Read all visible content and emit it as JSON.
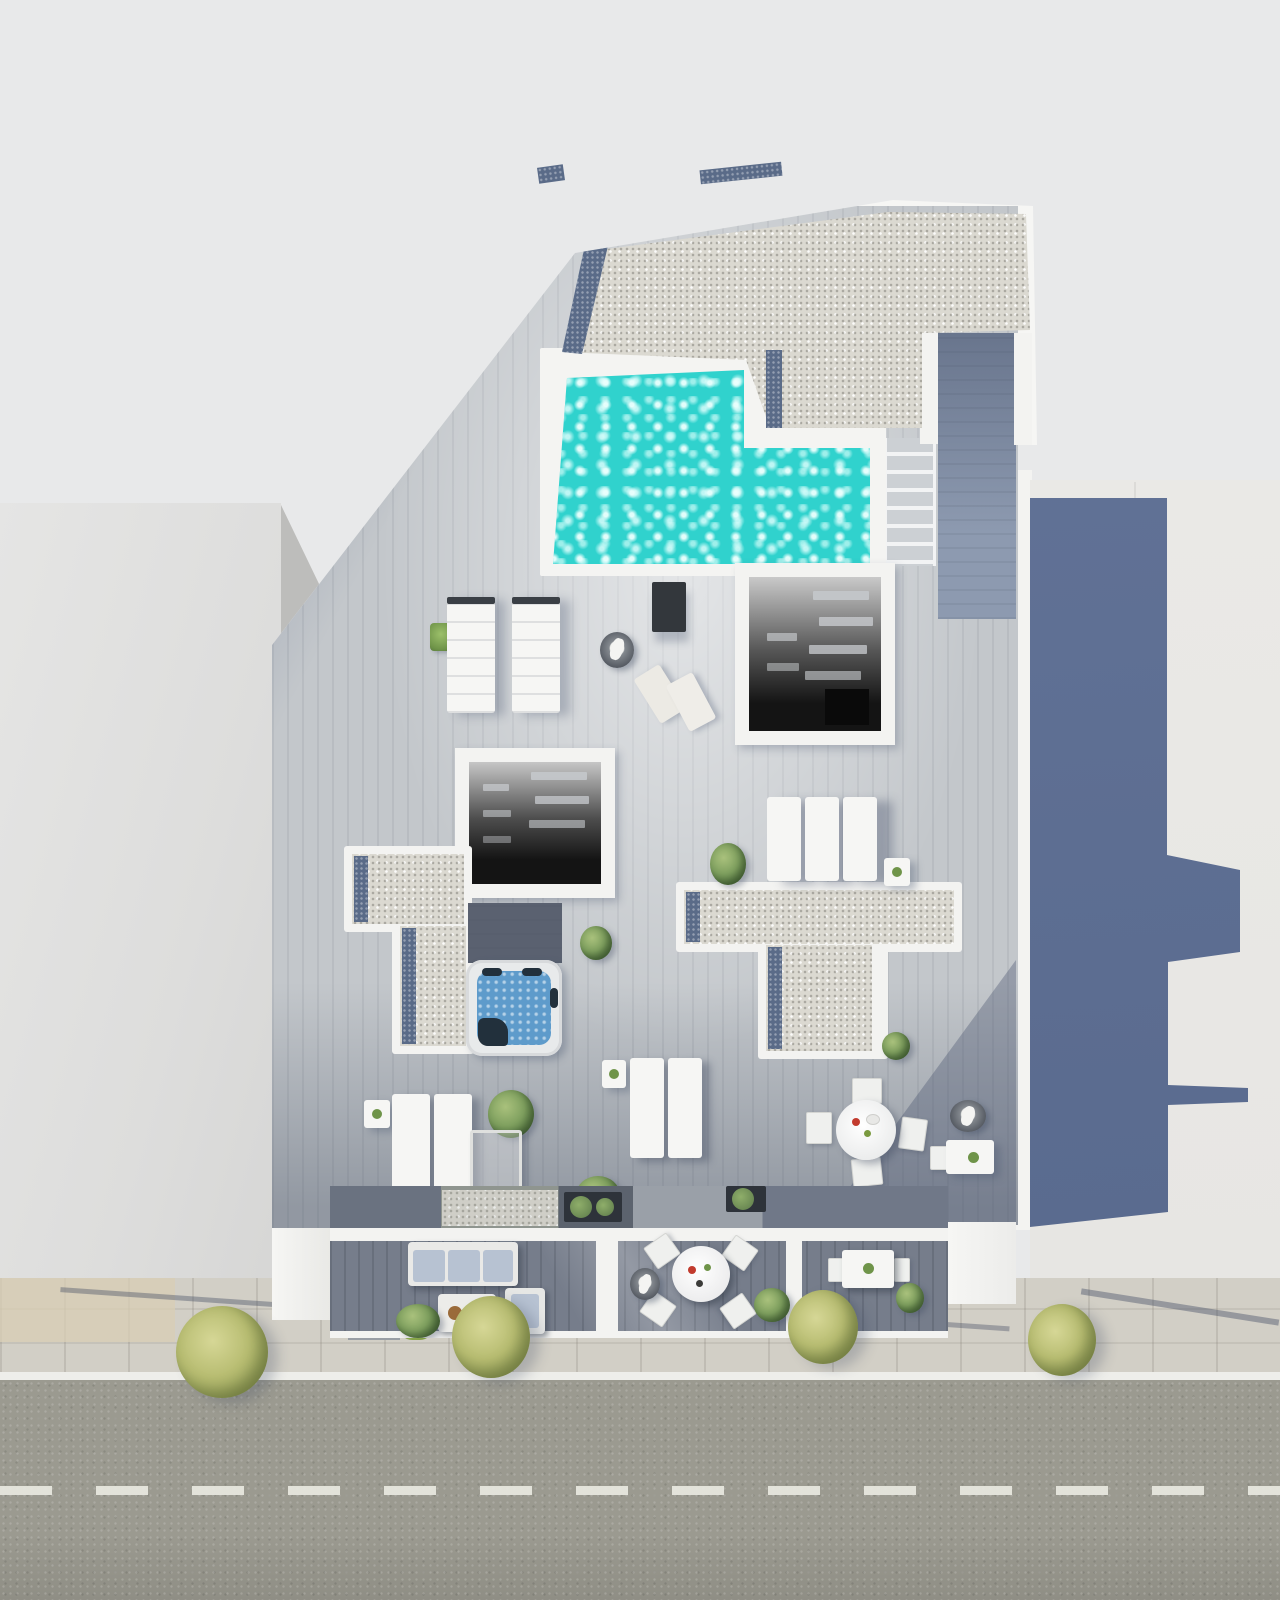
{
  "scene": {
    "type": "photorealistic 3D architectural render",
    "view": "top-down aerial",
    "subject": "rooftop terrace of a residential building with swimming pool, sun deck, jacuzzi, lounge furniture, neighboring rooftops and a street with trees"
  },
  "colors": {
    "canvasBg": "#e8e9ea",
    "neighborLeft": "#e2e2e1",
    "neighborWallFace": "#bdbdbb",
    "neighborRight": "#e9e8e5",
    "castShadowA": "#66769b",
    "castShadowB": "#57688c",
    "buildingWhite": "#f6f6f4",
    "parapetWhite": "#f3f3f1",
    "gravelLight": "#dbd9d1",
    "gravelBlue": "#5a6b88",
    "poolWater": "#30d2cd",
    "poolDeep": "#1c6f9f",
    "poolCoping": "#f4f4f2",
    "deckLight": "#c3c7cb",
    "walkwayShadow": "#7d8ba2",
    "atriumDark": "#141414",
    "stairTread": "#ccd0d4",
    "jacuzziShell": "#e8eaeb",
    "jacuzziWater": "#5e9bcb",
    "jacuzziDark": "#22303c",
    "furnitureWhite": "#f6f6f4",
    "cushionBlue": "#b7c2d2",
    "plantGreen": "#7fa05f",
    "plantDark": "#46643a",
    "treeGreen": "#b8bd72",
    "hedgeGreen": "#8fae4e",
    "planterDark": "#2e333a",
    "darkPanel": "#33373c",
    "terraceFloor": "#767d8b",
    "lowerStrip": "#6a7280",
    "sidewalk": "#d2cfc6",
    "sidewalkTan": "#d8cdb4",
    "curbWhite": "#eeeeea",
    "asphalt": "#9b9a90",
    "laneDash": "#e9e9e1"
  },
  "inventory": {
    "swimming_pool": "L-shaped rooftop pool with dark deep-end",
    "pool_stairs": 1,
    "stairwell_skylight_openings": 2,
    "gravel_roof_sections": 3,
    "jacuzzi_hot_tub": 1,
    "double_daybeds": 2,
    "sun_loungers": 7,
    "folded_deck_chairs": 2,
    "closed_parasols": 3,
    "round_dining_tables": 2,
    "rectangular_table": 1,
    "outdoor_sofa": 1,
    "coffee_table": 1,
    "side_tables": 4,
    "potted_plants_and_bushes": 12,
    "street_trees": 4,
    "hedges": 2,
    "road_with_dashed_center_line": true,
    "paved_sidewalk": true,
    "neighboring_buildings": 2
  }
}
